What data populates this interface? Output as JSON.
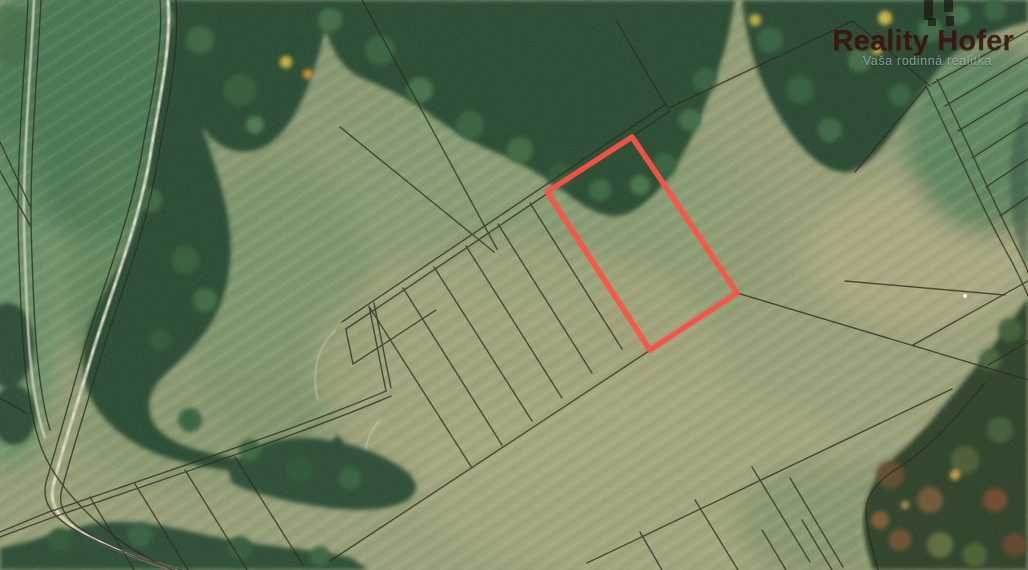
{
  "watermark": {
    "title": "Reality Hofer",
    "tagline": "Vaša rodinná realitka",
    "title_color": "rgba(64,17,9,0.85)",
    "tagline_color": "rgba(202,212,218,0.62)"
  },
  "map": {
    "line_color": "#2e2e22"
  },
  "parcel": {
    "points": "632,137 737,293 650,350 547,192",
    "outline_color": "#fb5347",
    "stroke_width": "5.5"
  }
}
